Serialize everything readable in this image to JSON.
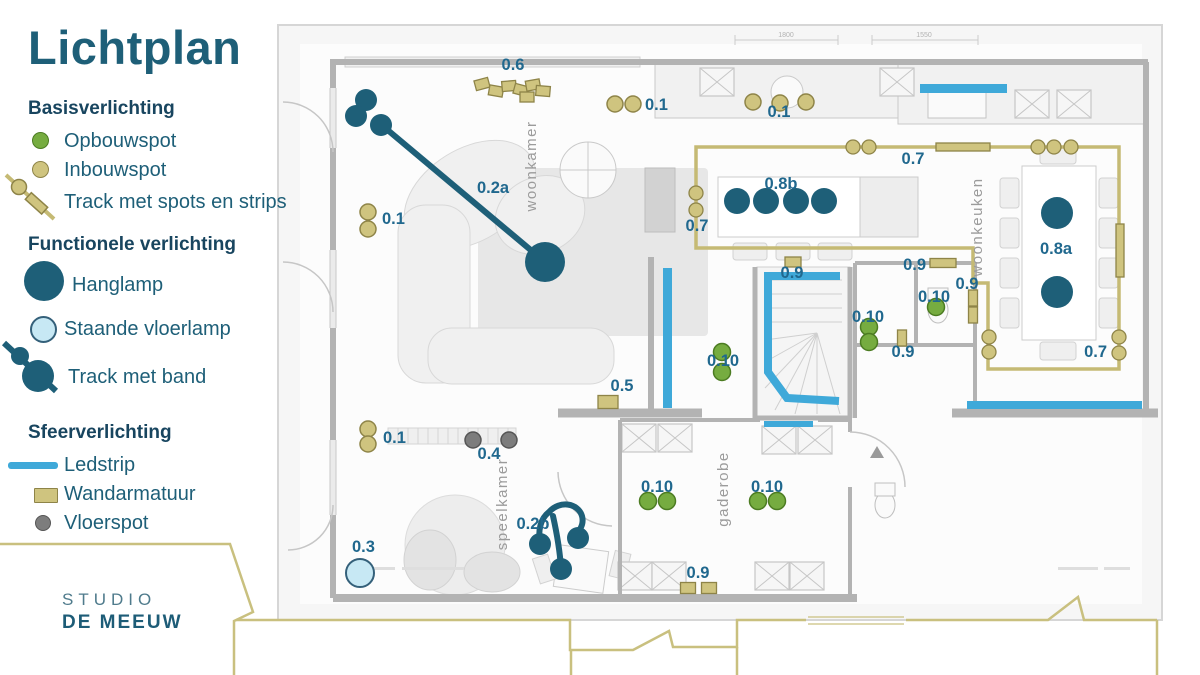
{
  "title": "Lichtplan",
  "brand": {
    "line1": "STUDIO",
    "line2": "DE MEEUW"
  },
  "colors": {
    "teal": "#1e5f78",
    "label": "#20688e",
    "green_fill": "#76ac40",
    "green_stroke": "#4c7c22",
    "olive_fill": "#cfc47f",
    "olive_stroke": "#8e8448",
    "olive_line": "#c5ba74",
    "gray_fill": "#7d7d7d",
    "gray_stroke": "#555555",
    "ledstrip": "#3fa9d9",
    "vloerlamp_fill": "#c7e8f4",
    "vloerlamp_stroke": "#34607a",
    "room_label": "#9b9b9b",
    "dim_label": "#b2b2b2"
  },
  "legend": {
    "sections": [
      {
        "heading": "Basisverlichting",
        "items": [
          {
            "icon": "opbouwspot-icon",
            "label": "Opbouwspot"
          },
          {
            "icon": "inbouwspot-icon",
            "label": "Inbouwspot"
          },
          {
            "icon": "track-spots-icon",
            "label": "Track met spots en strips"
          }
        ]
      },
      {
        "heading": "Functionele verlichting",
        "items": [
          {
            "icon": "hanglamp-icon",
            "label": "Hanglamp"
          },
          {
            "icon": "vloerlamp-icon",
            "label": "Staande vloerlamp"
          },
          {
            "icon": "track-band-icon",
            "label": "Track met band"
          }
        ]
      },
      {
        "heading": "Sfeerverlichting",
        "items": [
          {
            "icon": "ledstrip-icon",
            "label": "Ledstrip"
          },
          {
            "icon": "wandarmatuur-icon",
            "label": "Wandarmatuur"
          },
          {
            "icon": "vloerspot-icon",
            "label": "Vloerspot"
          }
        ]
      }
    ]
  },
  "plan": {
    "rooms": [
      [
        "woonkamer",
        536,
        166
      ],
      [
        "woonkeuken",
        982,
        227
      ],
      [
        "speelkamer",
        507,
        504
      ],
      [
        "gaderobe",
        728,
        489
      ]
    ],
    "dimensions": [
      [
        "1800",
        786,
        40
      ],
      [
        "1550",
        924,
        40
      ]
    ],
    "labels": [
      [
        "0.6",
        513,
        70,
        "middle"
      ],
      [
        "0.1",
        645,
        110,
        "start"
      ],
      [
        "0.1",
        779,
        117,
        "middle"
      ],
      [
        "0.1",
        382,
        224,
        "start"
      ],
      [
        "0.1",
        383,
        443,
        "start"
      ],
      [
        "0.2a",
        493,
        193,
        "middle"
      ],
      [
        "0.2b",
        533,
        529,
        "middle"
      ],
      [
        "0.3",
        352,
        552,
        "start"
      ],
      [
        "0.4",
        489,
        459,
        "middle"
      ],
      [
        "0.5",
        622,
        391,
        "middle"
      ],
      [
        "0.7",
        913,
        164,
        "middle"
      ],
      [
        "0.7",
        697,
        231,
        "middle"
      ],
      [
        "0.7",
        1107,
        357,
        "end"
      ],
      [
        "0.8b",
        781,
        189,
        "middle"
      ],
      [
        "0.8a",
        1056,
        254,
        "middle"
      ],
      [
        "0.9",
        792,
        278,
        "middle"
      ],
      [
        "0.9",
        926,
        270,
        "end"
      ],
      [
        "0.9",
        967,
        289,
        "middle"
      ],
      [
        "0.9",
        903,
        357,
        "middle"
      ],
      [
        "0.9",
        698,
        578,
        "middle"
      ],
      [
        "0.10",
        723,
        366,
        "middle"
      ],
      [
        "0.10",
        868,
        322,
        "middle"
      ],
      [
        "0.10",
        934,
        302,
        "middle"
      ],
      [
        "0.10",
        657,
        492,
        "middle"
      ],
      [
        "0.10",
        767,
        492,
        "middle"
      ]
    ],
    "track_07": {
      "path": "M696,147 L1119,147 L1119,369 L988,369 L988,283 L973,283 L973,248 L696,248 Z",
      "strips": [
        [
          936,
          143,
          54,
          8
        ],
        [
          1116,
          224,
          8,
          53
        ]
      ],
      "dots": [
        [
          853,
          147
        ],
        [
          869,
          147
        ],
        [
          1038,
          147
        ],
        [
          1054,
          147
        ],
        [
          1071,
          147
        ],
        [
          696,
          193
        ],
        [
          696,
          210
        ],
        [
          989,
          337
        ],
        [
          989,
          352
        ],
        [
          1119,
          337
        ],
        [
          1119,
          353
        ]
      ]
    },
    "track_02a": {
      "line": [
        384,
        127,
        545,
        262
      ],
      "dots": [
        [
          366,
          100,
          11
        ],
        [
          356,
          116,
          11
        ],
        [
          381,
          125,
          11
        ],
        [
          545,
          262,
          20
        ]
      ]
    },
    "track_02b": {
      "path": "M549,512 C560,500 578,503 582,516 C585,527 576,532 577,538 M549,512 C540,519 538,531 540,543 M553,516 C557,534 560,553 561,568",
      "dots": [
        [
          540,
          544,
          11
        ],
        [
          578,
          538,
          11
        ],
        [
          561,
          569,
          11
        ]
      ]
    },
    "ledstrips": {
      "rects": [
        [
          920,
          84,
          87,
          9
        ],
        [
          663,
          268,
          9,
          140
        ],
        [
          764,
          421,
          49,
          6
        ],
        [
          967,
          401,
          175,
          8
        ]
      ],
      "paths": [
        "M840,276 L768,276 L768,372 L787,398 L839,401"
      ]
    },
    "wandarmatuur": [
      [
        482,
        84,
        14,
        10,
        -15
      ],
      [
        496,
        91,
        14,
        10,
        10
      ],
      [
        509,
        86,
        14,
        10,
        -5
      ],
      [
        521,
        90,
        14,
        10,
        15
      ],
      [
        533,
        85,
        14,
        10,
        -10
      ],
      [
        543,
        91,
        14,
        10,
        5
      ],
      [
        527,
        97,
        14,
        10,
        0
      ],
      [
        608,
        402,
        20,
        13,
        0
      ],
      [
        793,
        262,
        16,
        10,
        0
      ],
      [
        943,
        263,
        26,
        9,
        0
      ],
      [
        973,
        298,
        9,
        16,
        0
      ],
      [
        973,
        315,
        9,
        16,
        0
      ],
      [
        902,
        338,
        9,
        16,
        0
      ],
      [
        688,
        588,
        15,
        11,
        0
      ],
      [
        709,
        588,
        15,
        11,
        0
      ]
    ],
    "inbouwspot": [
      [
        615,
        104
      ],
      [
        633,
        104
      ],
      [
        753,
        102
      ],
      [
        780,
        103
      ],
      [
        806,
        102
      ],
      [
        368,
        212
      ],
      [
        368,
        229
      ],
      [
        368,
        429
      ],
      [
        368,
        444
      ]
    ],
    "opbouwspot": [
      [
        722,
        352
      ],
      [
        722,
        372
      ],
      [
        869,
        327
      ],
      [
        869,
        342
      ],
      [
        936,
        307
      ],
      [
        648,
        501
      ],
      [
        667,
        501
      ],
      [
        758,
        501
      ],
      [
        777,
        501
      ]
    ],
    "vloerspot": [
      [
        473,
        440
      ],
      [
        509,
        440
      ]
    ],
    "vloerlamp": [
      [
        360,
        573
      ]
    ],
    "hanglamp": [
      [
        737,
        201,
        13
      ],
      [
        766,
        201,
        13
      ],
      [
        796,
        201,
        13
      ],
      [
        824,
        201,
        13
      ],
      [
        1057,
        213,
        16
      ],
      [
        1057,
        292,
        16
      ]
    ]
  }
}
